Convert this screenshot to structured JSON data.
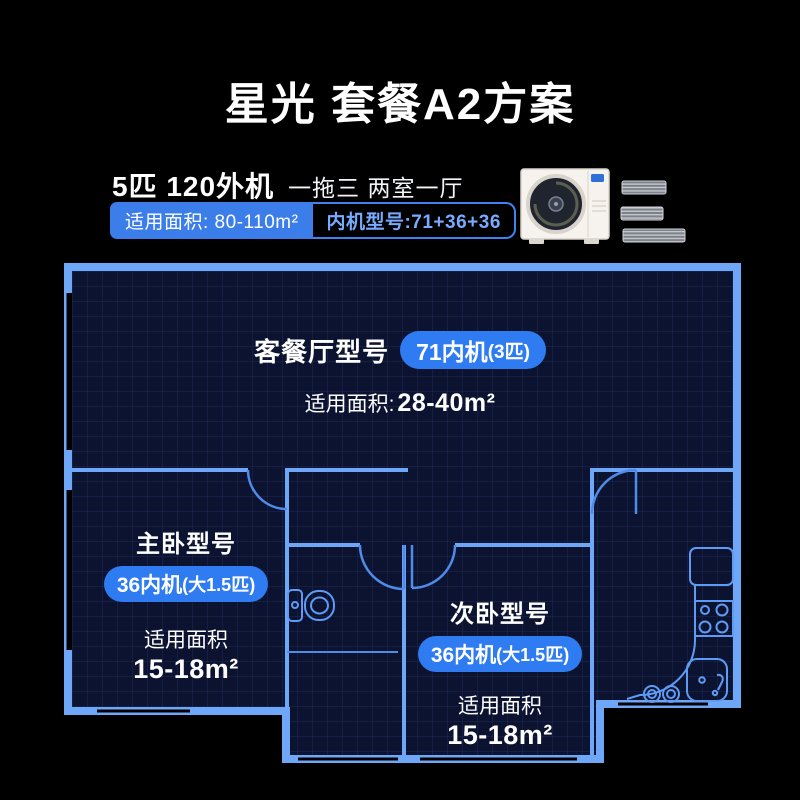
{
  "colors": {
    "bg": "#000000",
    "plan": "#0C1330",
    "wall": "#6FA7F8",
    "accent": "#2F7CF2",
    "accent2": "#3C7EE9",
    "door": "#4F8BE8",
    "line": "#5E9BF5",
    "lightblue": "#77ABFF"
  },
  "header": {
    "title": "星光 套餐A2方案"
  },
  "product": {
    "spec_bold": "5匹 120外机",
    "spec_light": "一拖三 两室一厅",
    "area_label": "适用面积: 80-110m²",
    "indoor_models_label": "内机型号:71+36+36"
  },
  "floorplan": {
    "living_room": {
      "name": "客餐厅型号",
      "badge_model": "71内机",
      "badge_spec": "(3匹)",
      "area_label": "适用面积:",
      "area_value": "28-40m²"
    },
    "master_bedroom": {
      "name": "主卧型号",
      "badge_model": "36内机",
      "badge_spec": "(大1.5匹)",
      "area_label": "适用面积",
      "area_value": "15-18m²"
    },
    "second_bedroom": {
      "name": "次卧型号",
      "badge_model": "36内机",
      "badge_spec": "(大1.5匹)",
      "area_label": "适用面积",
      "area_value": "15-18m²"
    }
  }
}
